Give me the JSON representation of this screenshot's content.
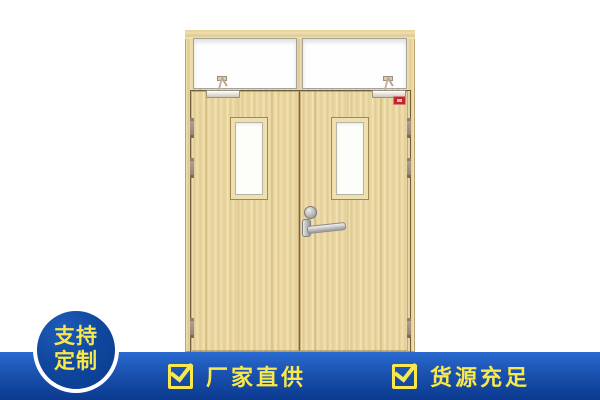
{
  "product": {
    "alt": "wooden double fire door with transom windows, vision panels, overhead door closers, lever handle, lock cylinder, hinges and red fire-rating label",
    "wood_color": "#ecd9a4",
    "fire_label_color": "#c4252b"
  },
  "badge": {
    "text_line1": "支持",
    "text_line2": "定制",
    "circle_color": "#10489f",
    "ring_color": "#ffffff",
    "text_color": "#f8e84b"
  },
  "banner": {
    "gradient_top": "#2a6bd0",
    "gradient_bottom": "#0b3a8f",
    "text_color": "#f8e84b",
    "items": [
      {
        "icon": "checkbox-checked-icon",
        "label": "厂家直供"
      },
      {
        "icon": "checkbox-checked-icon",
        "label": "货源充足"
      }
    ]
  }
}
